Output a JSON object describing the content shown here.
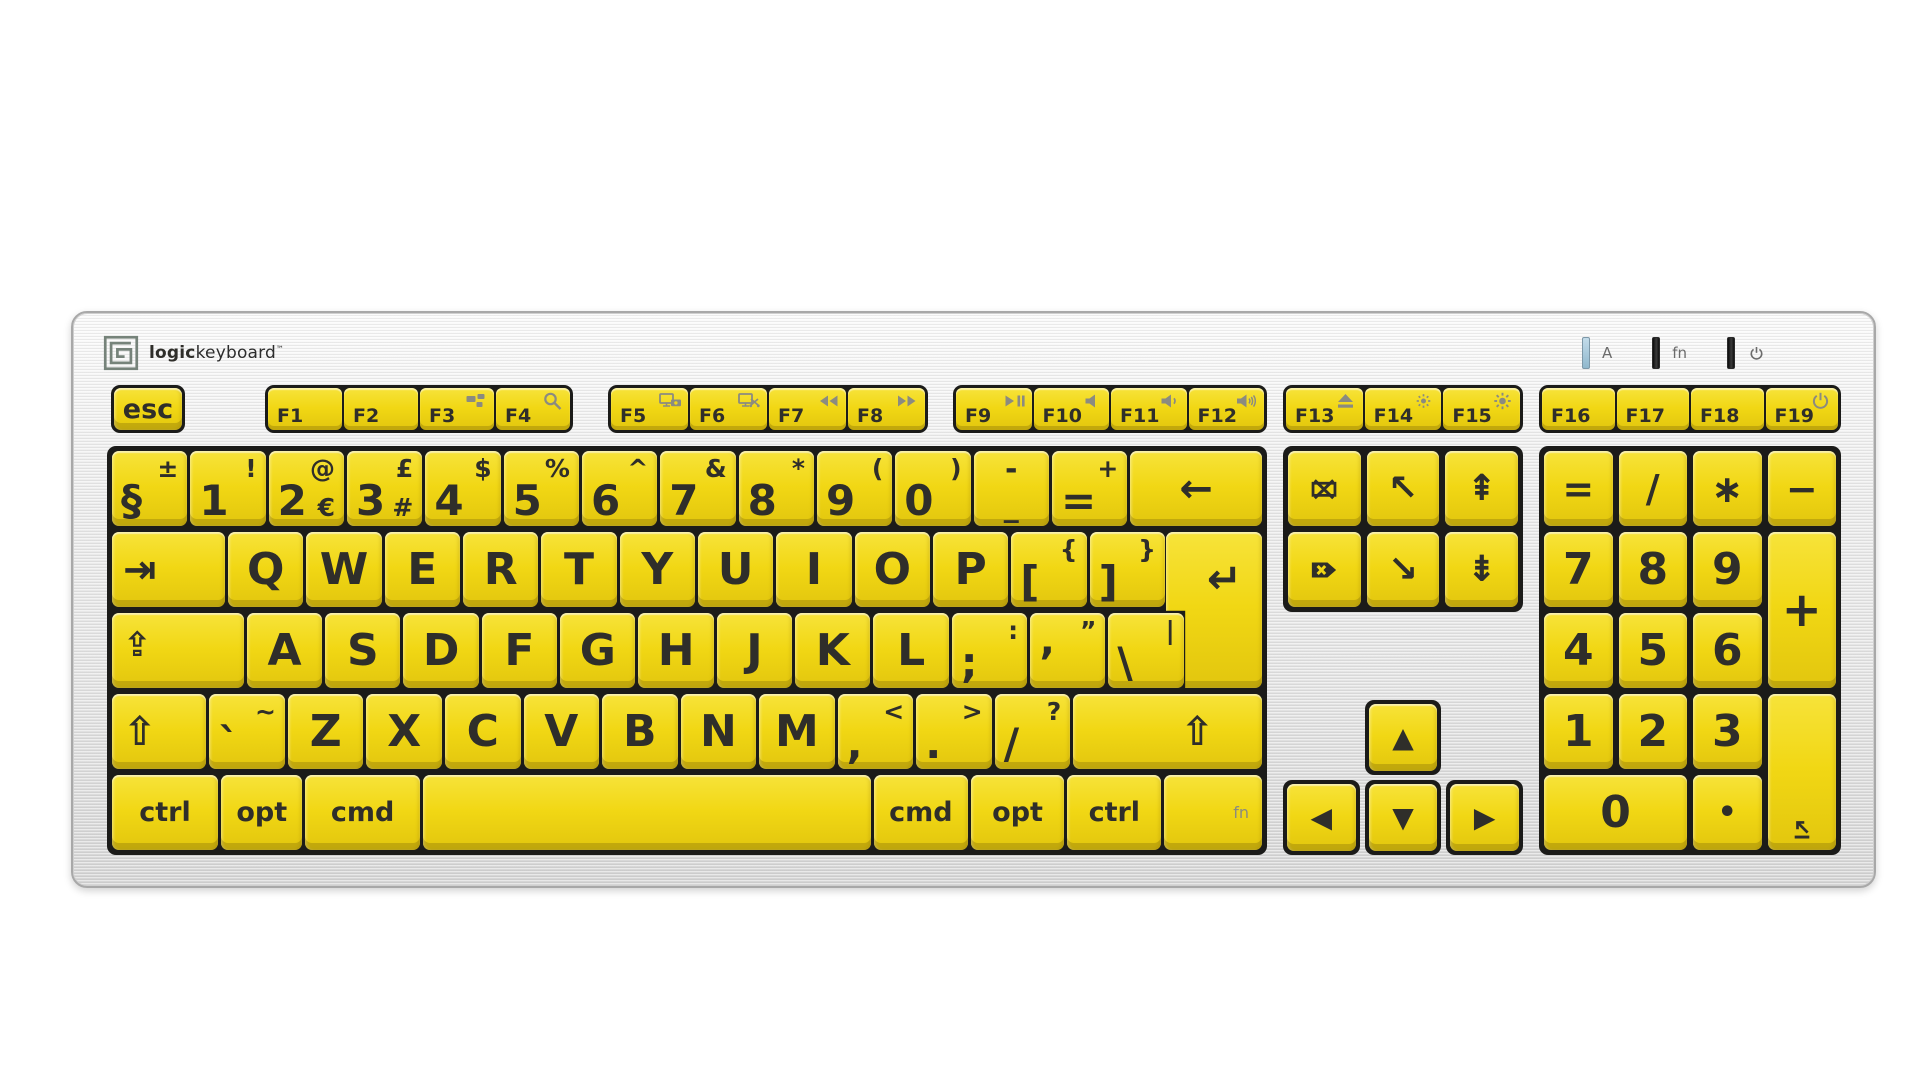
{
  "brand": {
    "bold": "logic",
    "regular": "keyboard",
    "tm": "™"
  },
  "indicators": [
    {
      "name": "caps-lock-indicator",
      "led": "blue",
      "label": "A"
    },
    {
      "name": "fn-indicator",
      "led": "dark",
      "label": "fn"
    },
    {
      "name": "power-indicator",
      "led": "dark",
      "icon": "power"
    }
  ],
  "function_row": {
    "esc": {
      "n": "key-esc",
      "p": "esc",
      "cls": "esckey"
    },
    "groups": [
      {
        "keys": [
          {
            "n": "key-f1",
            "p": "F1"
          },
          {
            "n": "key-f2",
            "p": "F2"
          },
          {
            "n": "key-f3",
            "p": "F3",
            "svg": "mission-control"
          },
          {
            "n": "key-f4",
            "p": "F4",
            "svg": "search"
          }
        ]
      },
      {
        "keys": [
          {
            "n": "key-f5",
            "p": "F5",
            "svg": "screen-camera"
          },
          {
            "n": "key-f6",
            "p": "F6",
            "svg": "screen-scissors"
          },
          {
            "n": "key-f7",
            "p": "F7",
            "svg": "rewind"
          },
          {
            "n": "key-f8",
            "p": "F8",
            "svg": "fast-forward"
          }
        ]
      },
      {
        "keys": [
          {
            "n": "key-f9",
            "p": "F9",
            "svg": "play-pause"
          },
          {
            "n": "key-f10",
            "p": "F10",
            "svg": "mute"
          },
          {
            "n": "key-f11",
            "p": "F11",
            "svg": "volume-down"
          },
          {
            "n": "key-f12",
            "p": "F12",
            "svg": "volume-up"
          }
        ]
      },
      {
        "keys": [
          {
            "n": "key-f13",
            "p": "F13",
            "svg": "eject"
          },
          {
            "n": "key-f14",
            "p": "F14",
            "svg": "brightness-low"
          },
          {
            "n": "key-f15",
            "p": "F15",
            "svg": "brightness-high"
          }
        ]
      },
      {
        "keys": [
          {
            "n": "key-f16",
            "p": "F16"
          },
          {
            "n": "key-f17",
            "p": "F17"
          },
          {
            "n": "key-f18",
            "p": "F18"
          },
          {
            "n": "key-f19",
            "p": "F19",
            "svg": "power"
          }
        ]
      }
    ]
  },
  "main_rows": [
    [
      {
        "n": "key-section",
        "p": "§",
        "t": "±",
        "cls": "dual"
      },
      {
        "n": "key-1",
        "p": "1",
        "t": "!",
        "cls": "dual"
      },
      {
        "n": "key-2",
        "p": "2",
        "t": "@",
        "b": "€",
        "cls": "dual"
      },
      {
        "n": "key-3",
        "p": "3",
        "t": "£",
        "b": "#",
        "cls": "dual"
      },
      {
        "n": "key-4",
        "p": "4",
        "t": "$",
        "cls": "dual"
      },
      {
        "n": "key-5",
        "p": "5",
        "t": "%",
        "cls": "dual"
      },
      {
        "n": "key-6",
        "p": "6",
        "t": "^",
        "cls": "dual"
      },
      {
        "n": "key-7",
        "p": "7",
        "t": "&",
        "cls": "dual"
      },
      {
        "n": "key-8",
        "p": "8",
        "t": "*",
        "cls": "dual"
      },
      {
        "n": "key-9",
        "p": "9",
        "t": "(",
        "cls": "dual"
      },
      {
        "n": "key-0",
        "p": "0",
        "t": ")",
        "cls": "dual"
      },
      {
        "n": "key-minus",
        "t": "-",
        "p": "_",
        "cls": "stack"
      },
      {
        "n": "key-equals",
        "p": "=",
        "t": "+",
        "cls": "dual"
      },
      {
        "n": "key-backspace",
        "g": "backspace",
        "w": 1.75
      }
    ],
    [
      {
        "n": "key-tab",
        "g": "tab",
        "w": 1.5,
        "cls": "icon-left"
      },
      {
        "n": "key-q",
        "p": "Q",
        "cls": "letter"
      },
      {
        "n": "key-w",
        "p": "W",
        "cls": "letter"
      },
      {
        "n": "key-e",
        "p": "E",
        "cls": "letter"
      },
      {
        "n": "key-r",
        "p": "R",
        "cls": "letter"
      },
      {
        "n": "key-t",
        "p": "T",
        "cls": "letter"
      },
      {
        "n": "key-y",
        "p": "Y",
        "cls": "letter"
      },
      {
        "n": "key-u",
        "p": "U",
        "cls": "letter"
      },
      {
        "n": "key-i",
        "p": "I",
        "cls": "letter"
      },
      {
        "n": "key-o",
        "p": "O",
        "cls": "letter"
      },
      {
        "n": "key-p",
        "p": "P",
        "cls": "letter"
      },
      {
        "n": "key-bracket-open",
        "p": "[",
        "t": "{",
        "cls": "dual"
      },
      {
        "n": "key-bracket-close",
        "p": "]",
        "t": "}",
        "cls": "dual"
      },
      {
        "sp": true,
        "w": 1.25
      }
    ],
    [
      {
        "n": "key-capslock",
        "g": "capslock",
        "w": 1.75,
        "cls": "icon-left capskey"
      },
      {
        "n": "key-a",
        "p": "A",
        "cls": "letter"
      },
      {
        "n": "key-s",
        "p": "S",
        "cls": "letter"
      },
      {
        "n": "key-d",
        "p": "D",
        "cls": "letter"
      },
      {
        "n": "key-f",
        "p": "F",
        "cls": "letter"
      },
      {
        "n": "key-g",
        "p": "G",
        "cls": "letter"
      },
      {
        "n": "key-h",
        "p": "H",
        "cls": "letter"
      },
      {
        "n": "key-j",
        "p": "J",
        "cls": "letter"
      },
      {
        "n": "key-k",
        "p": "K",
        "cls": "letter"
      },
      {
        "n": "key-l",
        "p": "L",
        "cls": "letter"
      },
      {
        "n": "key-semicolon",
        "p": ";",
        "t": ":",
        "cls": "dual"
      },
      {
        "n": "key-quote",
        "p": "’",
        "t": "”",
        "cls": "dual"
      },
      {
        "n": "key-backslash",
        "p": "\\",
        "t": "|",
        "cls": "dual"
      },
      {
        "sp": true,
        "w": 1.0
      }
    ],
    [
      {
        "n": "key-shift-left",
        "g": "shift",
        "w": 1.25,
        "cls": "icon-left"
      },
      {
        "n": "key-grave",
        "p": "`",
        "t": "~",
        "cls": "dual"
      },
      {
        "n": "key-z",
        "p": "Z",
        "cls": "letter"
      },
      {
        "n": "key-x",
        "p": "X",
        "cls": "letter"
      },
      {
        "n": "key-c",
        "p": "C",
        "cls": "letter"
      },
      {
        "n": "key-v",
        "p": "V",
        "cls": "letter"
      },
      {
        "n": "key-b",
        "p": "B",
        "cls": "letter"
      },
      {
        "n": "key-n",
        "p": "N",
        "cls": "letter"
      },
      {
        "n": "key-m",
        "p": "M",
        "cls": "letter"
      },
      {
        "n": "key-comma",
        "p": ",",
        "t": "<",
        "cls": "dual"
      },
      {
        "n": "key-period",
        "p": ".",
        "t": ">",
        "cls": "dual"
      },
      {
        "n": "key-slash",
        "p": "/",
        "t": "?",
        "cls": "dual"
      },
      {
        "n": "key-shift-right",
        "g": "shift",
        "w": 2.5,
        "cls": "icon-right"
      }
    ],
    [
      {
        "n": "key-control-left",
        "p": "ctrl",
        "w": 1.3,
        "cls": "mod"
      },
      {
        "n": "key-option-left",
        "p": "opt",
        "w": 1.0,
        "cls": "mod"
      },
      {
        "n": "key-command-left",
        "p": "cmd",
        "w": 1.4,
        "cls": "mod"
      },
      {
        "n": "key-space",
        "w": 5.5
      },
      {
        "n": "key-command-right",
        "p": "cmd",
        "w": 1.15,
        "cls": "mod"
      },
      {
        "n": "key-option-right",
        "p": "opt",
        "w": 1.15,
        "cls": "mod"
      },
      {
        "n": "key-control-right",
        "p": "ctrl",
        "w": 1.15,
        "cls": "mod"
      },
      {
        "n": "key-fn",
        "p": "fn",
        "w": 1.2,
        "cls": "fnmod"
      }
    ]
  ],
  "return_key": {
    "n": "key-return",
    "g": "return"
  },
  "nav_cluster": [
    [
      {
        "n": "key-clear",
        "svg": "clear",
        "cls": "navsvg"
      },
      {
        "n": "key-home",
        "g": "home",
        "cls": "navg"
      },
      {
        "n": "key-pageup",
        "g": "pgup",
        "cls": "navg"
      }
    ],
    [
      {
        "n": "key-forward-delete",
        "svg": "forward-delete",
        "cls": "navsvg"
      },
      {
        "n": "key-end",
        "g": "end",
        "cls": "navg"
      },
      {
        "n": "key-pagedown",
        "g": "pgdn",
        "cls": "navg"
      }
    ]
  ],
  "arrow_cluster": [
    {
      "n": "key-arrow-up",
      "g": "up",
      "pos": "a-up"
    },
    {
      "n": "key-arrow-left",
      "g": "left",
      "pos": "a-left"
    },
    {
      "n": "key-arrow-down",
      "g": "down",
      "pos": "a-down"
    },
    {
      "n": "key-arrow-right",
      "g": "right",
      "pos": "a-right"
    }
  ],
  "numpad": [
    {
      "n": "numpad-equals",
      "p": "=",
      "cls": "npop"
    },
    {
      "n": "numpad-divide",
      "p": "/",
      "cls": "npop"
    },
    {
      "n": "numpad-multiply",
      "p": "∗",
      "cls": "npop"
    },
    {
      "n": "numpad-subtract",
      "p": "−",
      "cls": "npop"
    },
    {
      "n": "numpad-7",
      "p": "7"
    },
    {
      "n": "numpad-8",
      "p": "8"
    },
    {
      "n": "numpad-9",
      "p": "9"
    },
    {
      "n": "numpad-add",
      "p": "+",
      "rs": 2,
      "cls": "npop plus"
    },
    {
      "n": "numpad-4",
      "p": "4"
    },
    {
      "n": "numpad-5",
      "p": "5"
    },
    {
      "n": "numpad-6",
      "p": "6"
    },
    {
      "n": "numpad-1",
      "p": "1"
    },
    {
      "n": "numpad-2",
      "p": "2"
    },
    {
      "n": "numpad-3",
      "p": "3"
    },
    {
      "n": "numpad-enter",
      "svg": "numpad-enter",
      "rs": 2,
      "cls": "icon-bottom"
    },
    {
      "n": "numpad-0",
      "p": "0",
      "cs": 2
    },
    {
      "n": "numpad-decimal",
      "p": "•",
      "cls": "npdot"
    }
  ],
  "colors": {
    "cap": "#f1d714",
    "legend": "#2f2e2a",
    "well": "#1b1b19",
    "icon_gray": "#8b8b80",
    "led_blue": "#a9cbdd"
  }
}
